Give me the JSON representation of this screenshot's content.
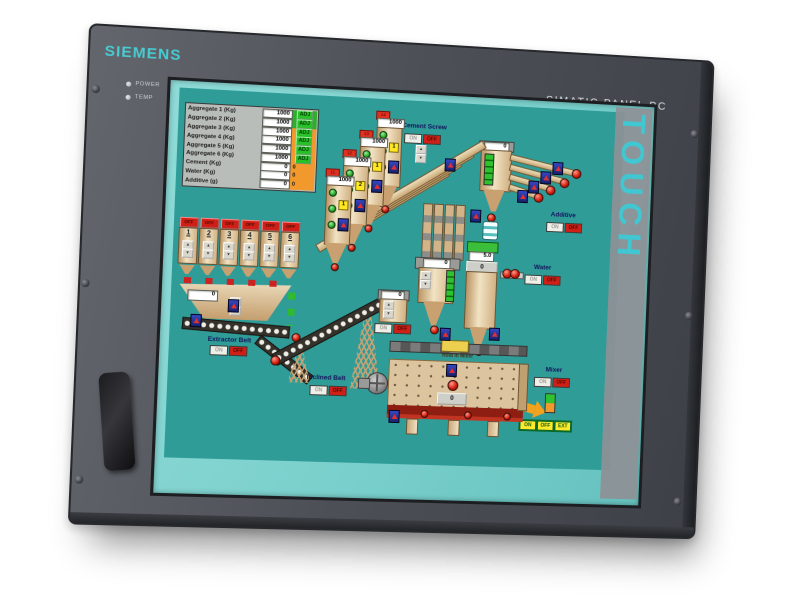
{
  "panel": {
    "brand": "SIEMENS",
    "model": "SIMATIC PANEL PC",
    "touch": "TOUCH",
    "leds": [
      {
        "label": "POWER"
      },
      {
        "label": "TEMP"
      }
    ]
  },
  "icons": {
    "up": "▲",
    "down": "▼"
  },
  "hmi": {
    "recipe": {
      "rows": [
        {
          "label": "Aggregate 1 (Kg)",
          "value": "1000",
          "action": "ADJ"
        },
        {
          "label": "Aggregate 2 (Kg)",
          "value": "1000",
          "action": "ADJ"
        },
        {
          "label": "Aggregate 3 (Kg)",
          "value": "1000",
          "action": "ADJ"
        },
        {
          "label": "Aggregate 4 (Kg)",
          "value": "1000",
          "action": "ADJ"
        },
        {
          "label": "Aggregate 5 (Kg)",
          "value": "1000",
          "action": "ADJ"
        },
        {
          "label": "Aggregate 6 (Kg)",
          "value": "1000",
          "action": "ADJ"
        },
        {
          "label": "Cement (Kg)",
          "value": "0",
          "action": "0"
        },
        {
          "label": "Water (Kg)",
          "value": "0",
          "action": "0"
        },
        {
          "label": "Additive (g)",
          "value": "0",
          "action": "0"
        }
      ]
    },
    "bins": [
      {
        "number": "1",
        "state": "OFF"
      },
      {
        "number": "2",
        "state": "OFF"
      },
      {
        "number": "3",
        "state": "OFF"
      },
      {
        "number": "4",
        "state": "OFF"
      },
      {
        "number": "5",
        "state": "OFF"
      },
      {
        "number": "6",
        "state": "OFF"
      }
    ],
    "silos": [
      {
        "tag": "11",
        "value": "1000",
        "dose": "1"
      },
      {
        "tag": "12",
        "value": "1000",
        "dose": "2"
      },
      {
        "tag": "13",
        "value": "1000",
        "dose": "1"
      },
      {
        "tag": "14",
        "value": "1000",
        "dose": "1"
      }
    ],
    "cement_screw": {
      "label": "Cement Screw",
      "on": "ON",
      "off": "OFF"
    },
    "extractor": {
      "label": "Extractor Belt",
      "on": "ON",
      "off": "OFF",
      "value": "0"
    },
    "inclined": {
      "label": "Inclined Belt",
      "on": "ON",
      "off": "OFF"
    },
    "feed_hopper": {
      "value": "0",
      "on": "ON",
      "off": "OFF"
    },
    "cement_hopper": {
      "value": "0"
    },
    "additive": {
      "label": "Additive",
      "on": "ON",
      "off": "OFF",
      "value": "0"
    },
    "water": {
      "label": "Water",
      "on": "ON",
      "off": "OFF",
      "setpoint": "5.0",
      "value": "0"
    },
    "mixer": {
      "label": "Mixer",
      "on": "ON",
      "off": "OFF",
      "title": "Hold in Mixer",
      "value": "0",
      "controls": [
        {
          "label": "ON"
        },
        {
          "label": "OFF"
        },
        {
          "label": "EXT"
        }
      ]
    }
  }
}
